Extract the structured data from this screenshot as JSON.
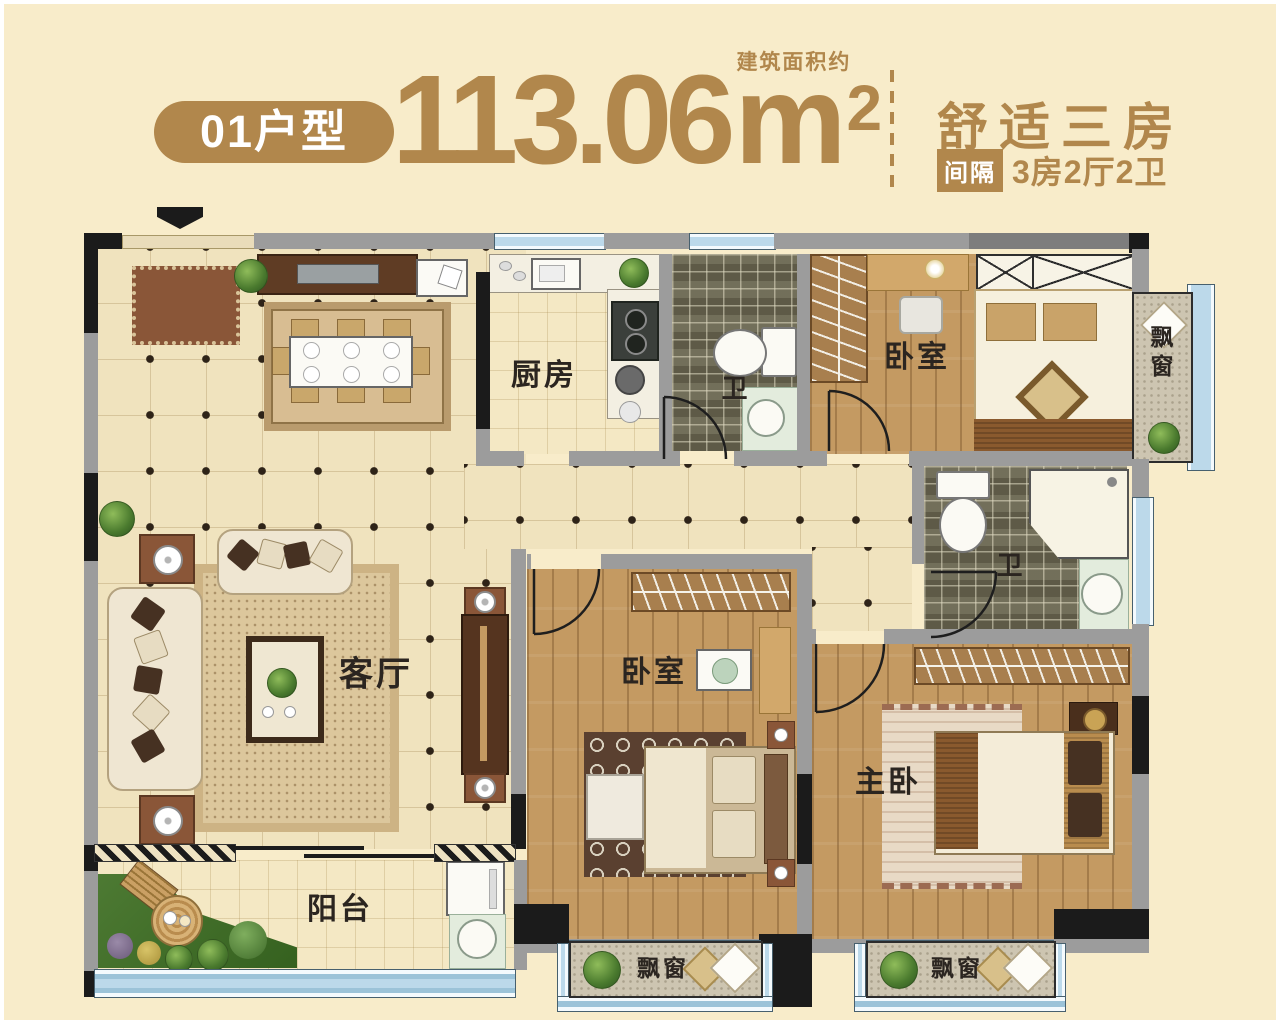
{
  "header": {
    "unit_badge": "01户型",
    "area_note": "建筑面积约",
    "area_value": "113.06",
    "area_unit_base": "m",
    "area_unit_sup": "2",
    "headline": "舒适三房",
    "layout_badge": "间隔",
    "layout_text": "3房2厅2卫"
  },
  "floorplan": {
    "rooms": {
      "kitchen": "厨房",
      "bath_top": "卫",
      "bedroom_top": "卧室",
      "bay_window_right": "飘窗",
      "bath_middle": "卫",
      "living": "客厅",
      "bedroom_middle": "卧室",
      "master_bedroom": "主卧",
      "balcony": "阳台",
      "bay_window_bottom_left": "飘窗",
      "bay_window_bottom_right": "飘窗"
    },
    "colors": {
      "accent": "#b1874c",
      "wall": "#9c9c9c",
      "wall_dark": "#1b1b1b",
      "floor_tile": "#f0e3be",
      "wood_floor": "#c49a62",
      "bath_tile": "#6b6751",
      "window_blue": "#bcd9ea",
      "bay_seat": "#cdc5b1",
      "page_background": "#f8ecca"
    }
  }
}
